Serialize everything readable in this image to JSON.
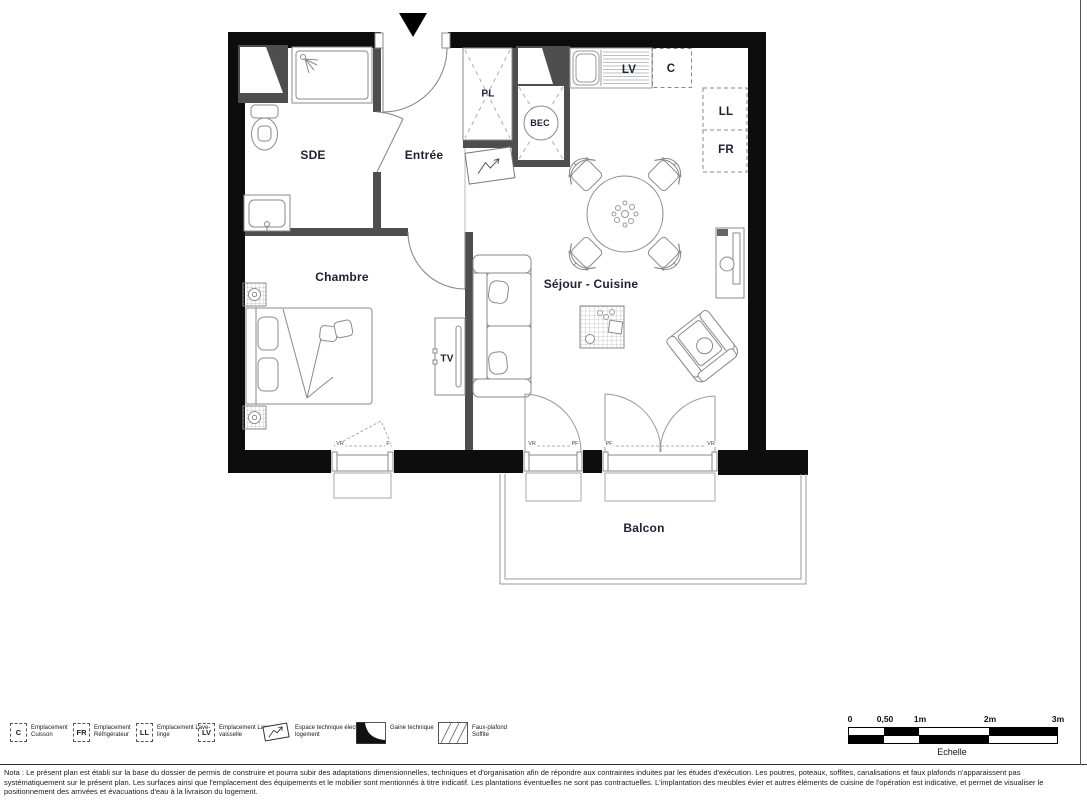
{
  "plan": {
    "rooms": {
      "sde": "SDE",
      "entree": "Entrée",
      "chambre": "Chambre",
      "sejour_cuisine": "Séjour - Cuisine",
      "balcon": "Balcon",
      "placard": "PL",
      "bec": "BEC",
      "tv": "TV"
    },
    "appliances": {
      "lave_vaisselle": "LV",
      "cuisson": "C",
      "lave_linge": "LL",
      "refrigerateur": "FR"
    },
    "window_tags": {
      "chambre_left": "VR",
      "chambre_right": "F",
      "sejour1_left": "VR",
      "sejour1_right": "PF",
      "sejour2_left": "PF",
      "sejour2_right": "VR"
    }
  },
  "legend": {
    "items": [
      {
        "code": "C",
        "label": "Emplacement Cuisson"
      },
      {
        "code": "FR",
        "label": "Emplacement Réfrigérateur"
      },
      {
        "code": "LL",
        "label": "Emplacement Lave-linge"
      },
      {
        "code": "LV",
        "label": "Emplacement Lave-vaisselle"
      },
      {
        "symbol": "electric-space-icon",
        "label": "Espace technique électrique du logement"
      },
      {
        "symbol": "gaine-technique-icon",
        "label": "Gaine technique"
      },
      {
        "symbol": "faux-plafond-icon",
        "label": "Faux-plafond Soffite"
      }
    ]
  },
  "scale_bar": {
    "ticks": [
      "0",
      "0,50",
      "1m",
      "2m",
      "3m"
    ],
    "label": "Echelle"
  },
  "nota": "Nota : Le présent plan est établi sur la base du dossier de permis de construire et pourra subir des adaptations dimensionnelles, techniques et d'organisation afin de répondre aux contraintes induites par les études d'exécution. Les poutres, poteaux, soffites, canalisations et faux plafonds n'apparaissent pas systématiquement sur le présent plan. Les surfaces ainsi que l'emplacement des équipements et le mobilier sont mentionnés à titre indicatif. Les plantations éventuelles ne sont pas contractuelles. L'implantation des meubles évier et autres éléments de cuisine de l'opération est indicative, et permet de visualiser le positionnement des arrivées et évacuations d'eau à la livraison du logement.",
  "colors": {
    "wall": "#0d0d0d",
    "partition": "#4e4e4e",
    "furniture_stroke": "#8a8a8a",
    "label_text": "#1c2133"
  }
}
